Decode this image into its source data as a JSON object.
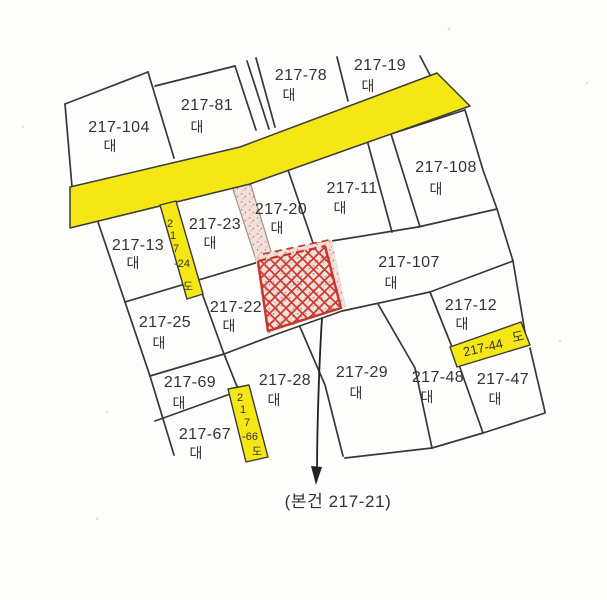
{
  "map": {
    "type": "cadastral-map",
    "parcels": [
      {
        "number": "217-104",
        "category": "대"
      },
      {
        "number": "217-81",
        "category": "대"
      },
      {
        "number": "217-78",
        "category": "대"
      },
      {
        "number": "217-19",
        "category": "대"
      },
      {
        "number": "217-108",
        "category": "대"
      },
      {
        "number": "217-11",
        "category": "대"
      },
      {
        "number": "217-20",
        "category": "대"
      },
      {
        "number": "217-23",
        "category": "대"
      },
      {
        "number": "217-13",
        "category": "대"
      },
      {
        "number": "217-107",
        "category": "대"
      },
      {
        "number": "217-22",
        "category": "대"
      },
      {
        "number": "217-25",
        "category": "대"
      },
      {
        "number": "217-12",
        "category": "대"
      },
      {
        "number": "217-69",
        "category": "대"
      },
      {
        "number": "217-28",
        "category": "대"
      },
      {
        "number": "217-29",
        "category": "대"
      },
      {
        "number": "217-48",
        "category": "대"
      },
      {
        "number": "217-47",
        "category": "대"
      },
      {
        "number": "217-67",
        "category": "대"
      }
    ],
    "road_strips": [
      {
        "number": "217-24",
        "category": "도",
        "chars": [
          "2",
          "1",
          "7",
          "-24",
          "도"
        ]
      },
      {
        "number": "217-66",
        "category": "도",
        "chars": [
          "2",
          "1",
          "7",
          "-66",
          "도"
        ]
      },
      {
        "number": "217-44",
        "category": "도"
      }
    ],
    "subject": {
      "parcel": "217-21",
      "callout": "(본건 217-21)"
    },
    "colors": {
      "road_yellow": "#f5e714",
      "subject_red": "#c9342c",
      "stipple_pink": "#f4e0da",
      "line": "#383838"
    }
  }
}
